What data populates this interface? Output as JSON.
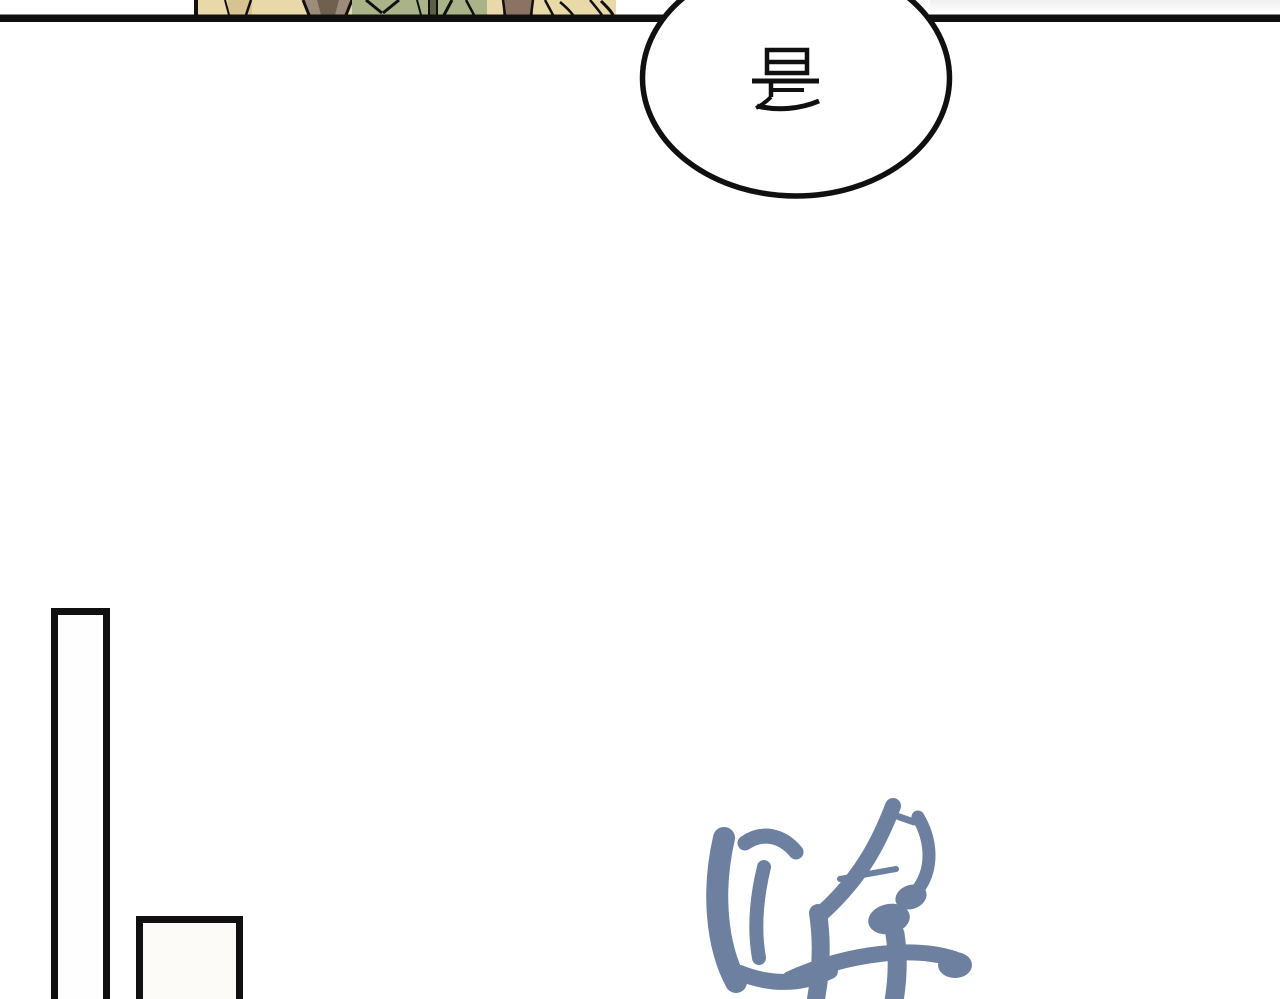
{
  "comic": {
    "speech_bubble": {
      "text": "是"
    },
    "sfx": {
      "text": "哗"
    },
    "colors": {
      "page-bg": "#ffffff",
      "ink": "#101010",
      "panel-tan": "#e9d9a9",
      "panel-tan-dark": "#d7c291",
      "panel-green": "#aab388",
      "panel-olive": "#5c5e48",
      "panel-brown": "#8b7363",
      "panel-gray-brown": "#9d8b7b",
      "panel-dark-brown": "#70614f",
      "right-strip-gray": "#f2f0f0",
      "frame-fill": "#fcfbf7",
      "sfx-blue": "#6d80a0"
    }
  }
}
